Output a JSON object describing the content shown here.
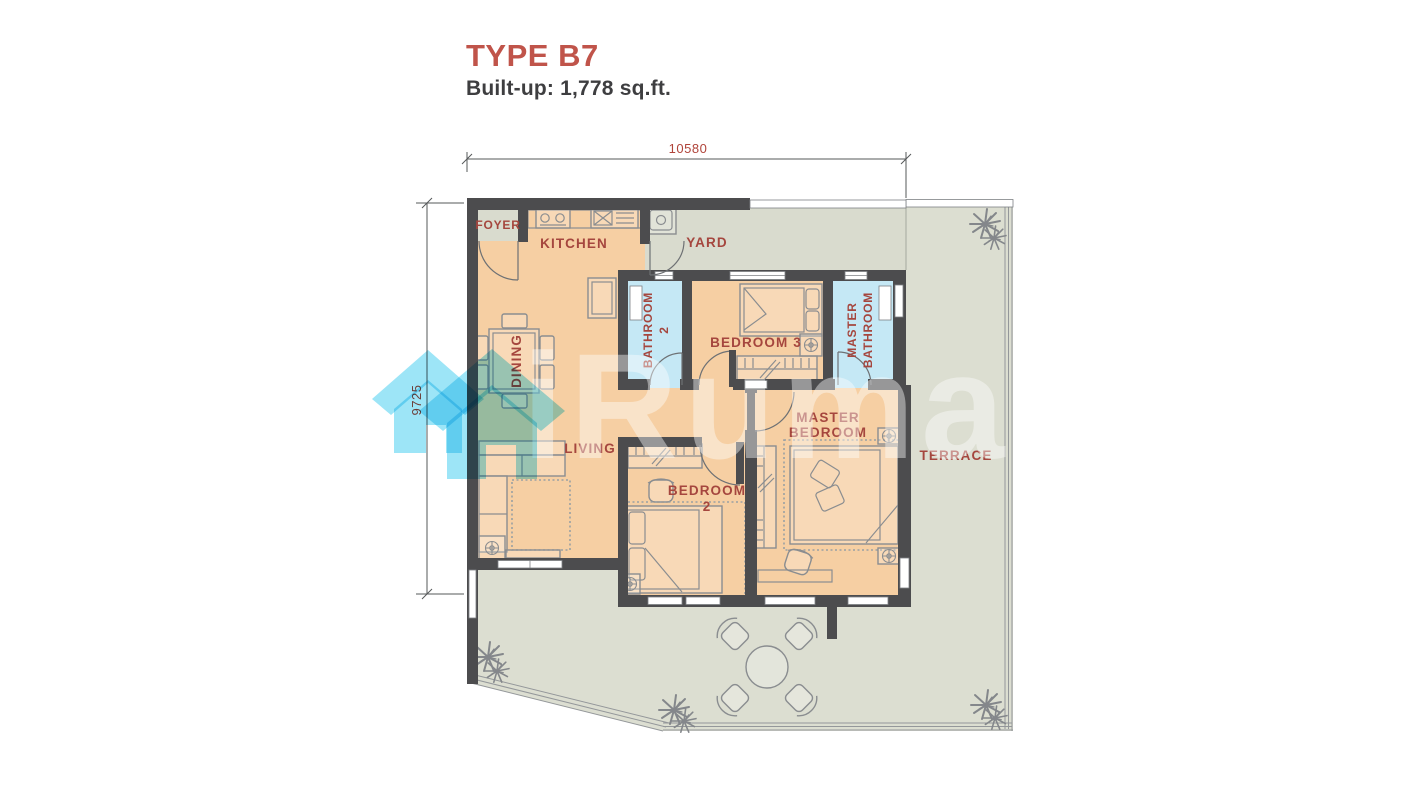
{
  "header": {
    "type_label": "TYPE B7",
    "built_up": "Built-up: 1,778 sq.ft."
  },
  "dimensions": {
    "top_width": "10580",
    "left_height": "9725"
  },
  "rooms": {
    "foyer": "FOYER",
    "kitchen": "KITCHEN",
    "yard": "YARD",
    "bathroom2": {
      "line1": "BATHROOM",
      "line2": "2"
    },
    "bedroom3": "BEDROOM 3",
    "master_bathroom": {
      "line1": "MASTER",
      "line2": "BATHROOM"
    },
    "dining": "DINING",
    "living": "LIVING",
    "bedroom2": {
      "line1": "BEDROOM",
      "line2": "2"
    },
    "master_bedroom": {
      "line1": "MASTER",
      "line2": "BEDROOM"
    },
    "terrace": "TERRACE"
  },
  "watermark": {
    "brand": "iRumah"
  },
  "colors": {
    "accent_red": "#b0443a",
    "title_red": "#c0544a",
    "floor_peach": "#f6cfa3",
    "outdoor_gray": "#dcded1",
    "bathroom_blue": "#c5e8f5",
    "wall_gray": "#4c4c4e",
    "logo_cyan": "#85dff5"
  }
}
